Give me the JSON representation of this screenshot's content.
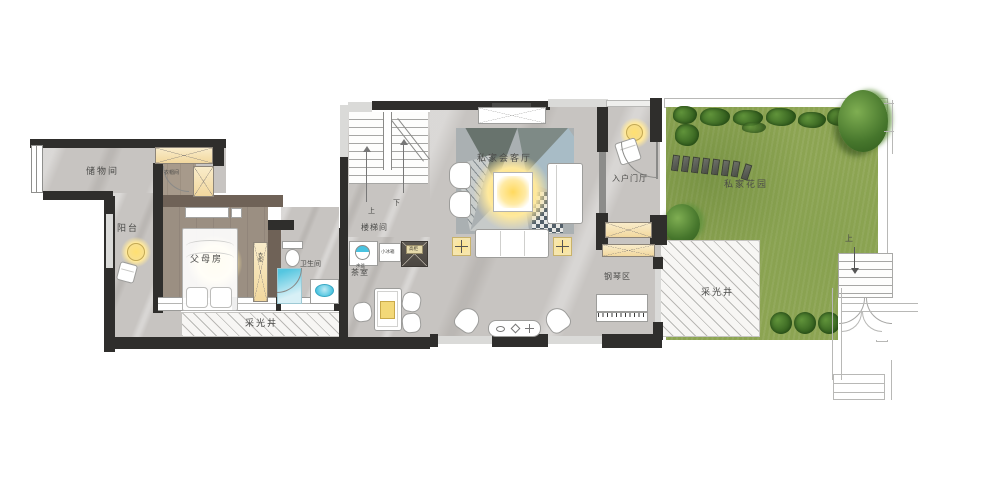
{
  "floor_plan": {
    "rooms": {
      "storage": {
        "label": "储物间"
      },
      "balcony": {
        "label": "阳台"
      },
      "cloakroom": {
        "label": "衣帽间"
      },
      "parents_room": {
        "label": "父母房"
      },
      "bathroom": {
        "label": "卫生间"
      },
      "stair_hall": {
        "label": "楼梯间"
      },
      "tea_room": {
        "label": "茶室"
      },
      "living_room": {
        "label": "私家会客厅"
      },
      "foyer": {
        "label": "入户门厅"
      },
      "piano_area": {
        "label": "钢琴区"
      },
      "garden": {
        "label": "私家花园"
      },
      "light_well_left": {
        "label": "采光井"
      },
      "light_well_right": {
        "label": "采光井"
      }
    },
    "annotations": {
      "stairs_up": "上",
      "stairs_down": "下",
      "garden_steps_up": "上",
      "wardrobe": "衣柜",
      "mini_fridge": "小冰箱",
      "basin": "水盆",
      "tall_cabinet": "高柜"
    },
    "colors": {
      "wall": "#2f2e2c",
      "wood_wall": "#6f6257",
      "marble_floor": "#c7c4c1",
      "wood_floor": "#9a8e81",
      "cabinet_fill": "#f5e2b4",
      "glow_yellow": "#ffd95e",
      "water_blue": "#49c3e0",
      "grass_green": "#8ca452",
      "hedge_green": "#335f1e",
      "rug_blue": "#a8bcc6"
    }
  }
}
